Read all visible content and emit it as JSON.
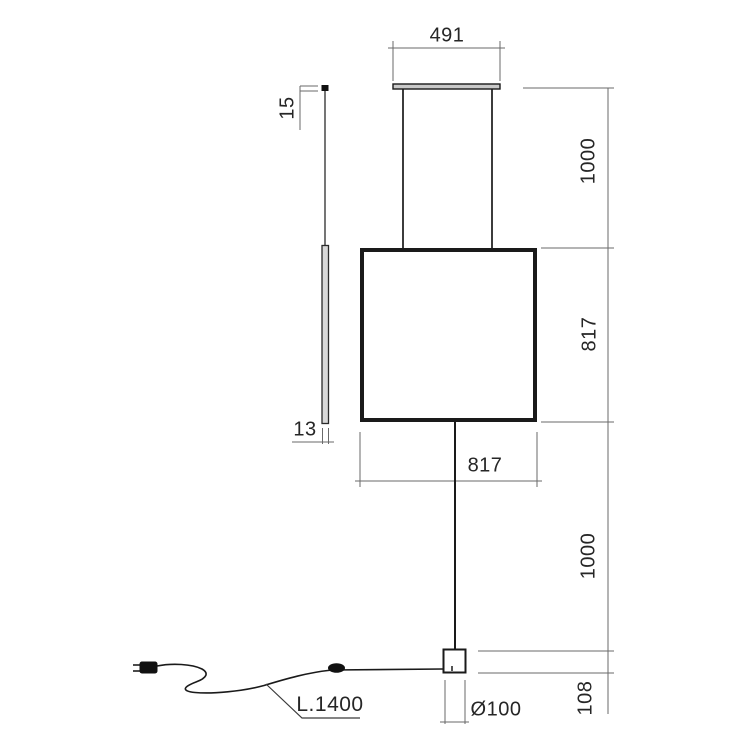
{
  "drawing": {
    "type": "technical-dimension-drawing",
    "subject": "suspended-square-panel-lamp-with-floor-base",
    "labels": {
      "top_width": "491",
      "upper_height": "1000",
      "panel_height": "817",
      "panel_width": "817",
      "lower_height": "1000",
      "base_height": "108",
      "base_diameter": "Ø100",
      "cord_length": "L.1400",
      "cap_height": "15",
      "profile_thickness": "13"
    },
    "colors": {
      "background": "#ffffff",
      "object_line": "#1a1a1a",
      "dimension_line": "#6a6a6a",
      "text": "#262626",
      "slab_fill": "#d8d8d8",
      "bar_fill": "#c9c9c9"
    }
  }
}
